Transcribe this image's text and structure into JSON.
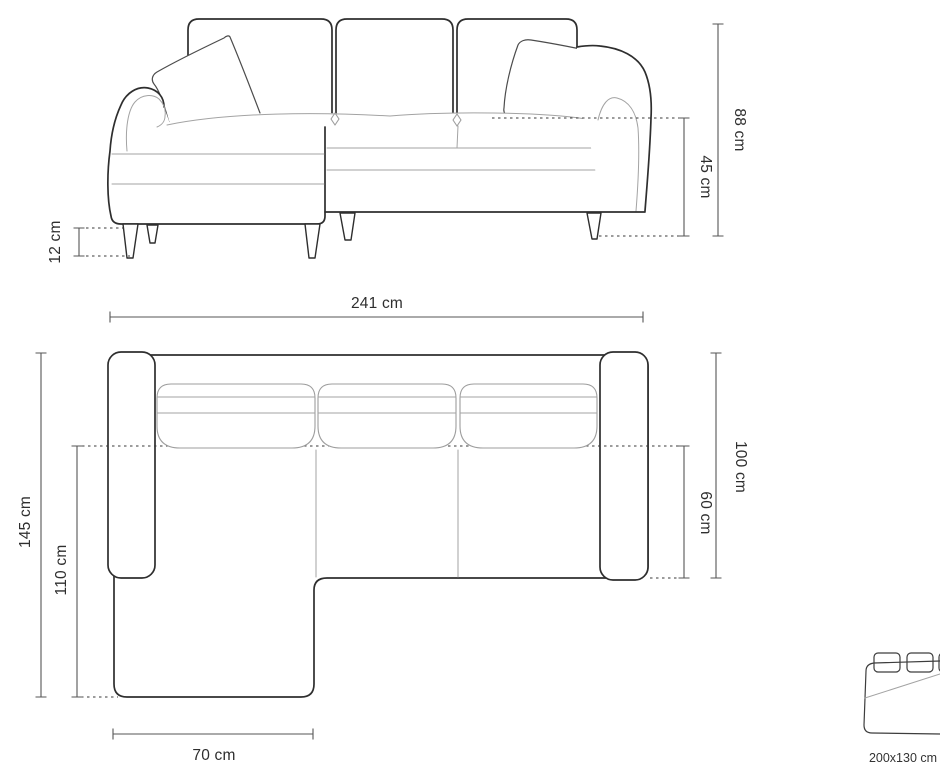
{
  "diagram": {
    "front_view": {
      "total_height": "88 cm",
      "seat_height": "45 cm",
      "leg_height": "12 cm",
      "total_width": "241 cm"
    },
    "top_view": {
      "total_depth": "145 cm",
      "chaise_length": "110 cm",
      "body_depth": "100 cm",
      "seat_depth": "60 cm",
      "chaise_width": "70 cm"
    },
    "bed": {
      "sleeping_area": "200x130 cm"
    }
  }
}
